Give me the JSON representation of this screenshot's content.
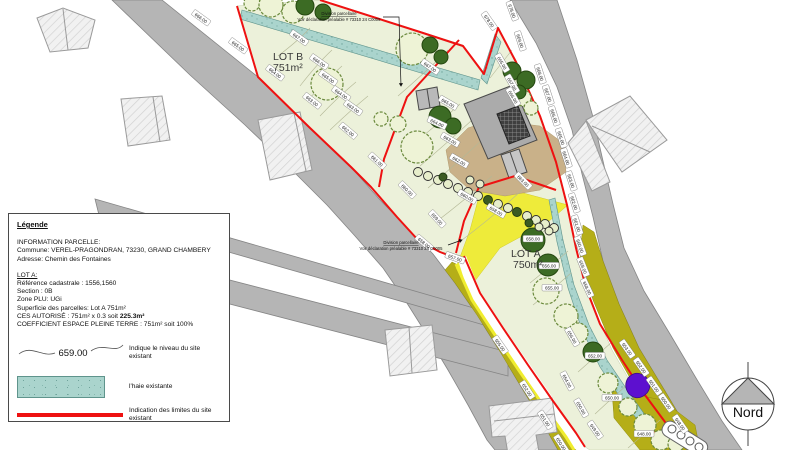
{
  "legend": {
    "title": "Légende",
    "info_title": "INFORMATION PARCELLE:",
    "commune": "Commune:  VEREL-PRAGONDRAN, 73230, GRAND CHAMBERY",
    "adresse": "Adresse: Chemin des Fontaines",
    "lot_title": "LOT A:",
    "reference": "Référence cadastrale : 1556,1560",
    "section": "Section : 0B",
    "zone": "Zone PLU: UGi",
    "superficie": "Superficie des parcelles: Lot A 751m²",
    "ces_prefix": "CES AUTORISÉ : 751m² x 0.3 soit ",
    "ces_value": "225.3m²",
    "coefficient": "COEFFICIENT ESPACE PLEINE TERRE : 751m² soit 100%",
    "niveau_value": "659.00",
    "niveau_desc": "Indique le niveau du site existant",
    "haie_desc": "l'haie existante",
    "limites_desc": "Indication des limites du site existant"
  },
  "plan": {
    "lot_b_name": "LOT B",
    "lot_b_area": "751m²",
    "lot_a_name": "LOT A",
    "lot_a_area": "750m²",
    "division_line1": "Division parcellaire",
    "division_line2": "Voir déclaration préalable # 73310 24 C0005",
    "compass_label": "Nord",
    "elev": [
      "678.00",
      "678.00",
      "669.00",
      "668.00",
      "667.00",
      "666.00",
      "665.00",
      "664.00",
      "663.00",
      "662.00",
      "661.00",
      "660.00",
      "659.00",
      "658.00",
      "656.00",
      "654.00",
      "650.00",
      "649.00",
      "653.00",
      "652.00",
      "651.00",
      "650.00",
      "648.00",
      "666.00",
      "665.00",
      "664.00",
      "663.00",
      "662.00",
      "661.00",
      "660.00",
      "659.00",
      "658.00",
      "657.00",
      "655.00",
      "652.00",
      "651.00",
      "650.00",
      "667.00",
      "666.00",
      "665.00",
      "664.00",
      "663.00",
      "667.00",
      "665.00",
      "667.00",
      "666.00",
      "664.00",
      "663.00",
      "662.00",
      "660.00",
      "658.00",
      "658.00",
      "656.00",
      "655.00",
      "652.00",
      "650.00",
      "648.00",
      "663.00",
      "665.00"
    ]
  },
  "colors": {
    "boundary_red": "#ee1111",
    "hedge_teal": "#aad4cd",
    "road_gray": "#b5b5b5",
    "parcel_green": "#ecf1da",
    "hedge_olive": "#b5ae18",
    "driveway_yellow": "#efec37",
    "courtyard_tan": "#c9b189",
    "tree_dark_green": "#3c6b24",
    "marker_purple": "#5d10cf"
  }
}
